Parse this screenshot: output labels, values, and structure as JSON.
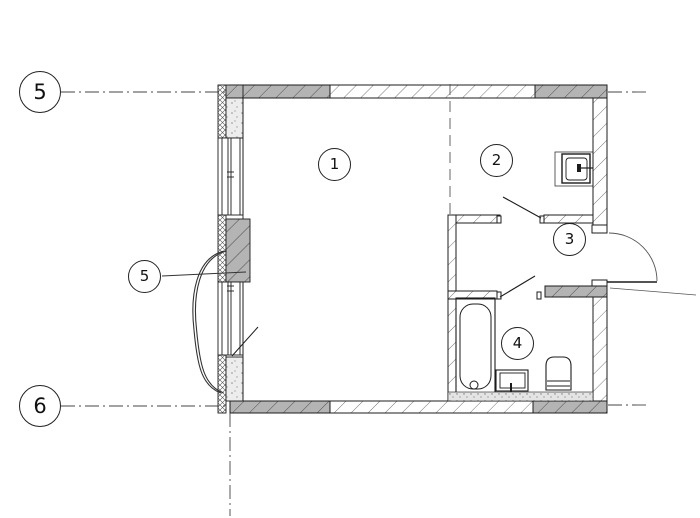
{
  "meta": {
    "drawing_type": "apartment floor plan (CAD screenshot)",
    "background": "#ffffff"
  },
  "axis_markers": {
    "top": {
      "label": "5"
    },
    "bottom": {
      "label": "6"
    }
  },
  "room_labels": {
    "room1": "1",
    "room2": "2",
    "room3": "3",
    "room4": "4",
    "balcony_unit": "5"
  },
  "fixtures": {
    "kitchen_sink": "sink-square-wall-mounted",
    "bathtub": "bathtub-with-drain",
    "washbasin": "washbasin",
    "toilet": "toilet-with-cistern",
    "entrance_door": "entrance-door-swing-right",
    "room_door_leaf": "interior-door-leaf",
    "bathroom_door_leaf": "bathroom-door-leaf",
    "balcony_door": "balcony-door-curve"
  },
  "colors": {
    "line": "#1c1c1c",
    "wall_gray": "#b4b4b4",
    "hatch_line": "#777777",
    "hatch_line_dark": "#4d4d4d",
    "concrete_speckle": "#ededed",
    "floor_stipple": "#e4e4e4",
    "grid_line": "#444444"
  }
}
